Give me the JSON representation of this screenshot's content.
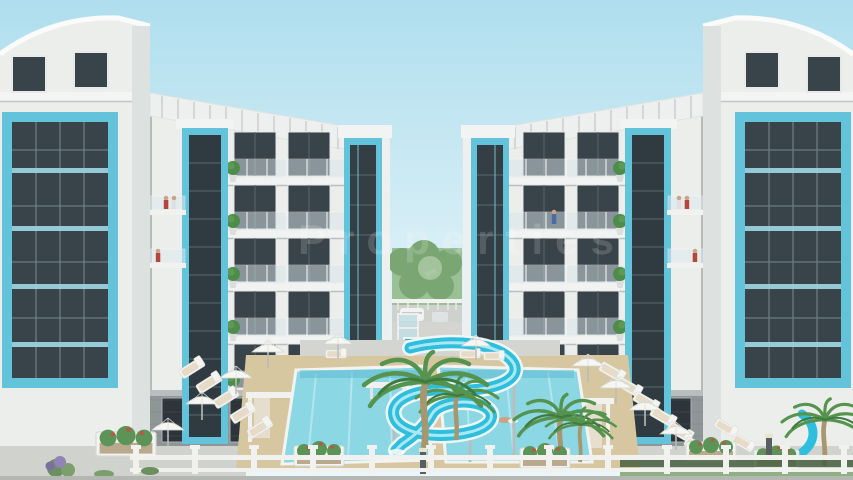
{
  "watermark": {
    "text": "Properties"
  },
  "palette": {
    "sky_top": "#afdeee",
    "sky_horizon": "#eaf6f9",
    "wall_white": "#eceeec",
    "roof_white": "#eef0ef",
    "accent_blue": "#62c3db",
    "glass_dark": "#39434a",
    "glass_band_blue": "#9ed8e5",
    "stone_base": "#8e9697",
    "storefront_glass": "#2e353a",
    "tree_green": "#9cc096",
    "tree_green_dark": "#7aa674",
    "pool_water": "#8bd7e4",
    "pool_deep": "#3fa6c1",
    "slide_blue": "#2fbedd",
    "slide_highlight": "#bff0f8",
    "sand_tan": "#d7c7a0",
    "deck_gray": "#d4d5d0",
    "palm_green": "#55934f",
    "palm_trunk": "#a8966f",
    "lounger_white": "#f4f4f1",
    "cushion_tan": "#e6dbc6",
    "umbrella_white": "#f6f6f3",
    "fence_white": "#f1f2ef",
    "planter_green": "#5c9457",
    "flower_red": "#bf5347",
    "hedge_green": "#46603f",
    "person_red": "#b5453d",
    "person_blue": "#4a6da6",
    "watermark_white": "#ffffff"
  }
}
